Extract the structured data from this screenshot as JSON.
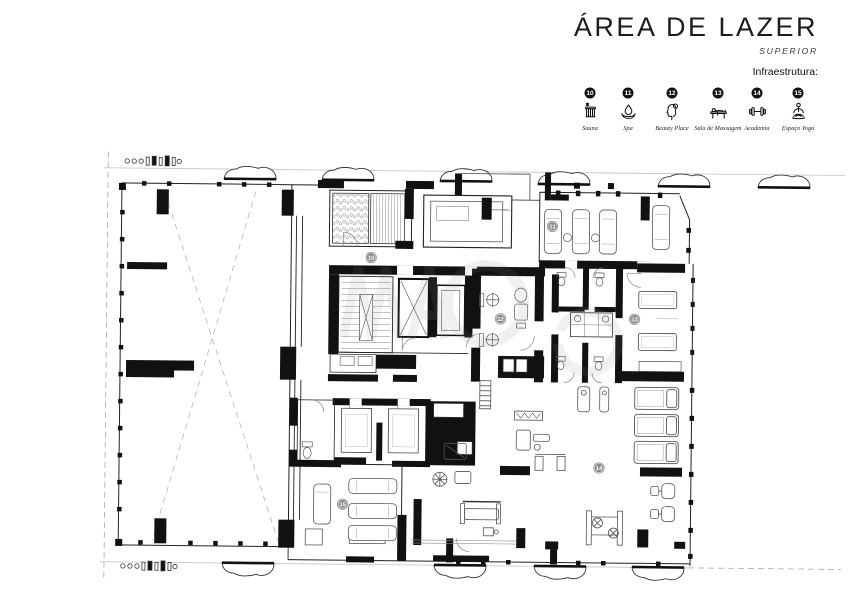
{
  "header": {
    "title": "ÁREA DE LAZER",
    "subtitle": "SUPERIOR"
  },
  "legend": {
    "heading": "Infraestrutura:",
    "items": [
      {
        "number": "10",
        "label": "Sauna",
        "icon": "sauna-icon"
      },
      {
        "number": "11",
        "label": "Spa",
        "icon": "spa-icon"
      },
      {
        "number": "12",
        "label": "Beauty Place",
        "icon": "beauty-place-icon"
      },
      {
        "number": "13",
        "label": "Sala de Massagem",
        "icon": "massage-table-icon"
      },
      {
        "number": "14",
        "label": "Academia",
        "icon": "dumbbell-icon"
      },
      {
        "number": "15",
        "label": "Espaço Yoga",
        "icon": "yoga-icon"
      }
    ]
  },
  "plan": {
    "badges": [
      {
        "number": "10",
        "x": 372,
        "y": 255
      },
      {
        "number": "11",
        "x": 553,
        "y": 222
      },
      {
        "number": "12",
        "x": 502,
        "y": 315
      },
      {
        "number": "13",
        "x": 636,
        "y": 314
      },
      {
        "number": "14",
        "x": 602,
        "y": 463
      },
      {
        "number": "15",
        "x": 346,
        "y": 502
      }
    ],
    "colors": {
      "wall": "#111111",
      "furniture_line": "#555555",
      "light_line": "#aaaaaa",
      "badge_fill": "#8a8a8a",
      "badge_text": "#ffffff"
    }
  }
}
